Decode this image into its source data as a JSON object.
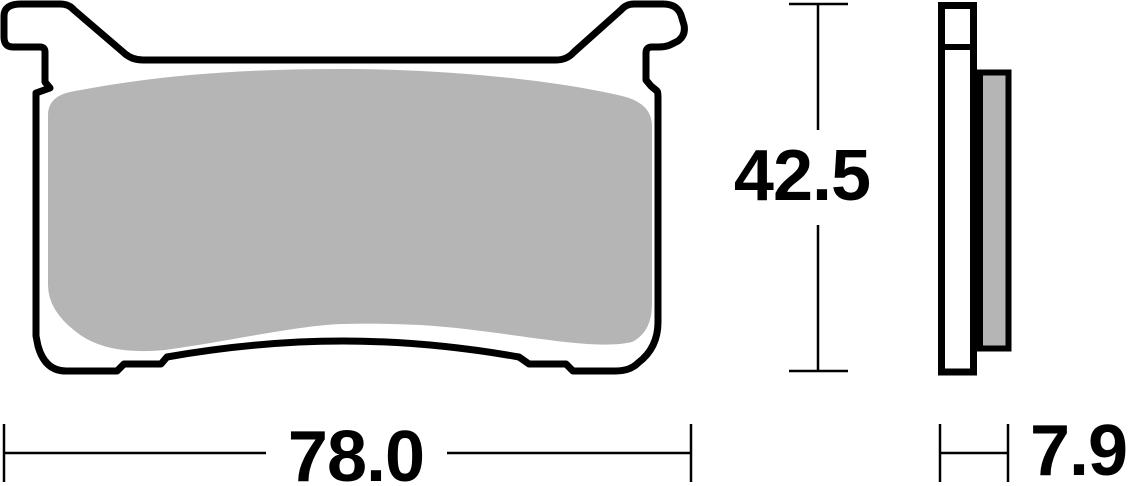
{
  "drawing": {
    "subject": "brake-pad-technical-drawing",
    "views": {
      "front": "front-profile-view",
      "side": "side-thickness-view"
    },
    "colors": {
      "outline": "#000000",
      "friction_material": "#b5b5b5",
      "backplate_fill": "#ffffff",
      "background": "#ffffff"
    },
    "dimensions": {
      "width_mm": "78.0",
      "height_mm": "42.5",
      "thickness_mm": "7.9"
    }
  }
}
